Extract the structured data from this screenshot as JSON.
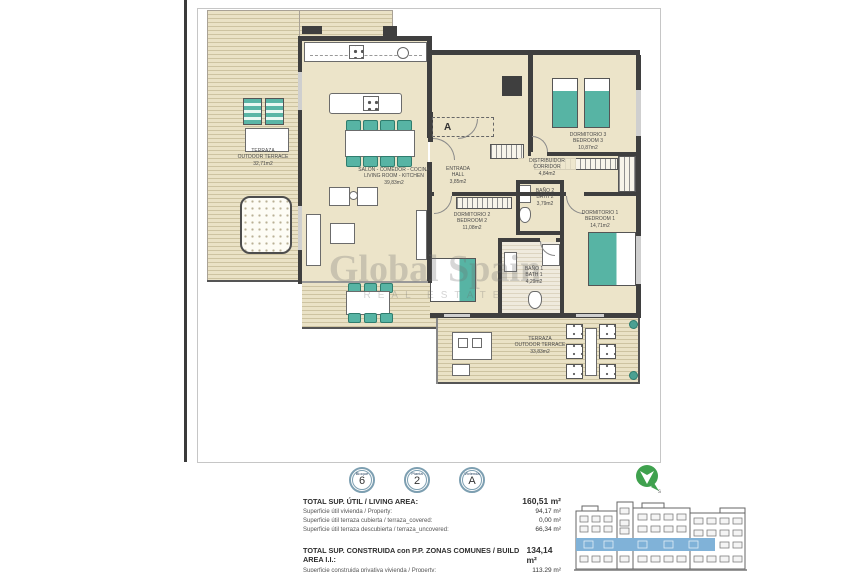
{
  "plan": {
    "section_marker": "A",
    "rooms": {
      "terrace_left": {
        "name_es": "TERRAZA",
        "name_en": "OUTDOOR TERRACE",
        "area": "32,71m2"
      },
      "living": {
        "name_es": "SALON - COMEDOR - COCINA",
        "name_en": "LIVING ROOM - KITCHEN",
        "area": "39,83m2"
      },
      "entrada": {
        "name_es": "ENTRADA",
        "name_en": "HALL",
        "area": "3,85m2"
      },
      "distribuidor": {
        "name_es": "DISTRIBUIDOR",
        "name_en": "CORRIDOR",
        "area": "4,84m2"
      },
      "dorm3": {
        "name_es": "DORMITORIO 3",
        "name_en": "BEDROOM 3",
        "area": "10,87m2"
      },
      "dorm2": {
        "name_es": "DORMITORIO 2",
        "name_en": "BEDROOM 2",
        "area": "11,08m2"
      },
      "dorm1": {
        "name_es": "DORMITORIO 1",
        "name_en": "BEDROOM 1",
        "area": "14,71m2"
      },
      "bano2": {
        "name_es": "BAÑO 2",
        "name_en": "BATH 2",
        "area": "3,79m2"
      },
      "bano1": {
        "name_es": "BAÑO 1",
        "name_en": "BATH 1",
        "area": "4,29m2"
      },
      "terrace_bottom": {
        "name_es": "TERRAZA",
        "name_en": "OUTDOOR TERRACE",
        "area": "33,83m2"
      }
    },
    "watermark": {
      "line1": "Global Spain",
      "line2": "REAL ESTATE"
    }
  },
  "panel": {
    "badges": [
      {
        "label": "Bloque",
        "value": "6"
      },
      {
        "label": "Planta",
        "value": "2"
      },
      {
        "label": "Vivienda",
        "value": "A"
      }
    ],
    "area_rows": [
      {
        "label": "TOTAL SUP. ÚTIL / LIVING AREA:",
        "value": "160,51 m²"
      },
      {
        "label": "Superficie útil vivienda / Property:",
        "value": "94,17 m²"
      },
      {
        "label": "Superficie útil terraza cubierta / terraza_covered:",
        "value": "0,00 m²"
      },
      {
        "label": "Superficie útil terraza descubierta / terraza_uncovered:",
        "value": "66,34 m²"
      }
    ],
    "build_rows": [
      {
        "label": "TOTAL SUP. CONSTRUIDA con P.P. ZONAS COMUNES / BUILD AREA I.I.:",
        "value": "134,14 m²"
      },
      {
        "label": "Superficie construida privativa vivienda / Property:",
        "value": "113,29 m²"
      }
    ],
    "compass_label": "s"
  }
}
